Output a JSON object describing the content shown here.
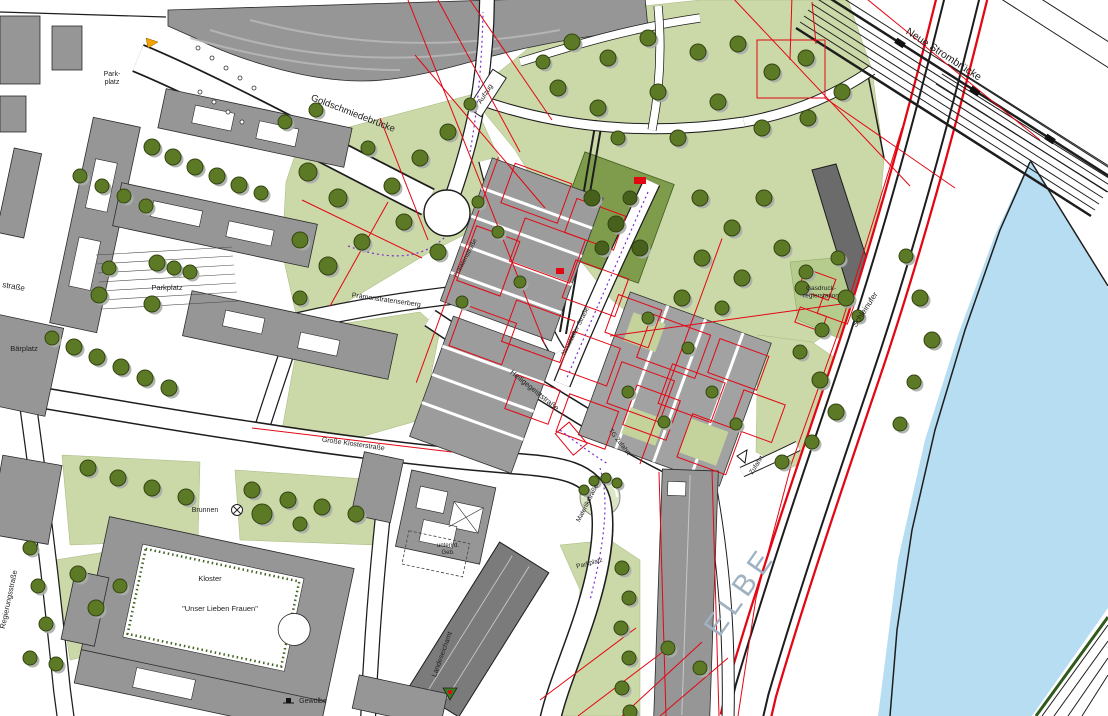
{
  "map": {
    "type": "city-development-plan",
    "colors": {
      "water": "#b7ddf2",
      "park": "#cbd8a7",
      "parkdark": "#7f9c4c",
      "tree": "#5c7a26",
      "tree_dark": "#47601c",
      "tree_shadow": "#a9aea9",
      "bld": "#969696",
      "bldd": "#7b7b7b",
      "boundary_red": "#e30613",
      "utility_purple": "#7a2fd0",
      "ink": "#1d1d1d",
      "elbe_text": "#9fb2c2",
      "marker_orange": "#f5a400"
    },
    "river_name": "ELBE",
    "labels": [
      {
        "id": "goldschmiedebruecke",
        "t": "Goldschmiedebrücke",
        "x": 352,
        "y": 116,
        "r": 21,
        "s": 9.5
      },
      {
        "id": "aufzug",
        "t": "Aufzug",
        "x": 487,
        "y": 95,
        "r": -57,
        "s": 7
      },
      {
        "id": "neue-strombruecke",
        "t": "Neue Strombrücke",
        "x": 942,
        "y": 57,
        "r": 33,
        "s": 10.5
      },
      {
        "id": "parkplatz-nordwest",
        "lines": [
          "Park-",
          "platz"
        ],
        "x": 112,
        "y": 76,
        "s": 7,
        "lh": 8
      },
      {
        "id": "strasse-fragment",
        "t": "straße",
        "x": 2,
        "y": 287,
        "r": 10,
        "s": 8,
        "a": "start"
      },
      {
        "id": "baerplatz",
        "t": "Bärplatz",
        "x": 24,
        "y": 351,
        "s": 7.5
      },
      {
        "id": "parkplatz-west",
        "t": "Parkplatz",
        "x": 167,
        "y": 290,
        "s": 7.5
      },
      {
        "id": "praemonstratenserberg",
        "t": "Prämonstratenserberg",
        "x": 386,
        "y": 302,
        "r": 8,
        "s": 7
      },
      {
        "id": "praelatenstrasse",
        "t": "Prälatenstraße",
        "x": 467,
        "y": 259,
        "r": -62,
        "s": 6.5
      },
      {
        "id": "neustaedter-strasse",
        "t": "Neustädter Straße",
        "x": 577,
        "y": 332,
        "r": -63,
        "s": 6.5
      },
      {
        "id": "heiligegeiststrasse",
        "t": "Heiligegeiststraße",
        "x": 533,
        "y": 392,
        "r": 39,
        "s": 7.5
      },
      {
        "id": "schleinufer",
        "t": "Schleinufer",
        "x": 867,
        "y": 311,
        "r": -57,
        "s": 8
      },
      {
        "id": "gasdruckreglerstation",
        "lines": [
          "Gasdruck-",
          "reglerstation"
        ],
        "x": 821,
        "y": 290,
        "s": 6.5,
        "lh": 7.5
      },
      {
        "id": "grosse-klosterstrasse",
        "t": "Große Klosterstraße",
        "x": 353,
        "y": 446,
        "r": 8,
        "s": 7
      },
      {
        "id": "tg-zufahrt",
        "t": "TG Zufahrt",
        "x": 618,
        "y": 443,
        "r": 52,
        "s": 6.5
      },
      {
        "id": "materlikstrasse",
        "t": "Materlikstraße",
        "x": 589,
        "y": 504,
        "r": -63,
        "s": 6.5
      },
      {
        "id": "brunnen",
        "t": "Brunnen",
        "x": 205,
        "y": 512,
        "s": 7
      },
      {
        "id": "kloster",
        "t": "Kloster",
        "x": 210,
        "y": 581,
        "s": 7.5
      },
      {
        "id": "unser-lieben-frauen",
        "t": "\"Unser Lieben Frauen\"",
        "x": 220,
        "y": 611,
        "s": 7.5
      },
      {
        "id": "regierungsstrasse",
        "t": "Regierungsstraße",
        "x": 11,
        "y": 600,
        "r": -78,
        "s": 7.5
      },
      {
        "id": "unterird-geb",
        "lines": [
          "unterird.",
          "Geb."
        ],
        "x": 448,
        "y": 547,
        "s": 6,
        "lh": 7
      },
      {
        "id": "landeseichamt",
        "t": "Landeseichamt",
        "x": 444,
        "y": 655,
        "r": -70,
        "s": 7
      },
      {
        "id": "parkplatz-sued",
        "t": "Parkplatz",
        "x": 590,
        "y": 565,
        "r": -15,
        "s": 6.5
      },
      {
        "id": "zufahrt",
        "t": "Zufahrt",
        "x": 758,
        "y": 466,
        "r": -57,
        "s": 6.5
      },
      {
        "id": "elbe",
        "t": "ELBE",
        "x": 748,
        "y": 597,
        "r": -55,
        "s": 30,
        "c": "#9fb2c2",
        "ls": 6
      },
      {
        "id": "gewoelbe",
        "t": "Gewölbe",
        "x": 313,
        "y": 703,
        "s": 7
      }
    ]
  }
}
